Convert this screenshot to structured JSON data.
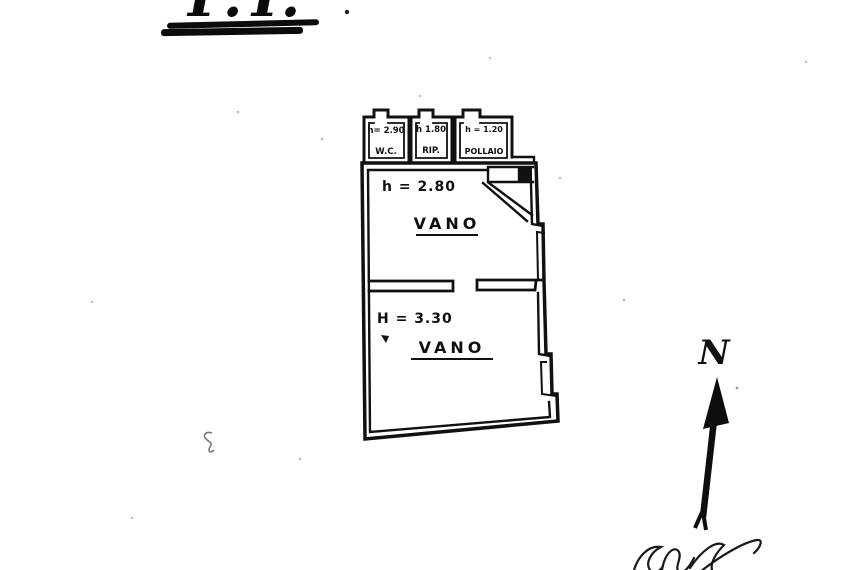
{
  "page": {
    "title": "P.T."
  },
  "plan": {
    "annex_rooms": [
      {
        "height": "h= 2.90",
        "name": "W.C."
      },
      {
        "height": "h 1.80",
        "name": "RIP."
      },
      {
        "height": "h = 1.20",
        "name": "POLLAIO"
      }
    ],
    "main_rooms": [
      {
        "height": "h = 2.80",
        "name": "VANO"
      },
      {
        "height": "H = 3.30",
        "name": "VANO"
      }
    ],
    "north_label": "N"
  },
  "colors": {
    "ink": "#111111",
    "paper": "#ffffff"
  }
}
